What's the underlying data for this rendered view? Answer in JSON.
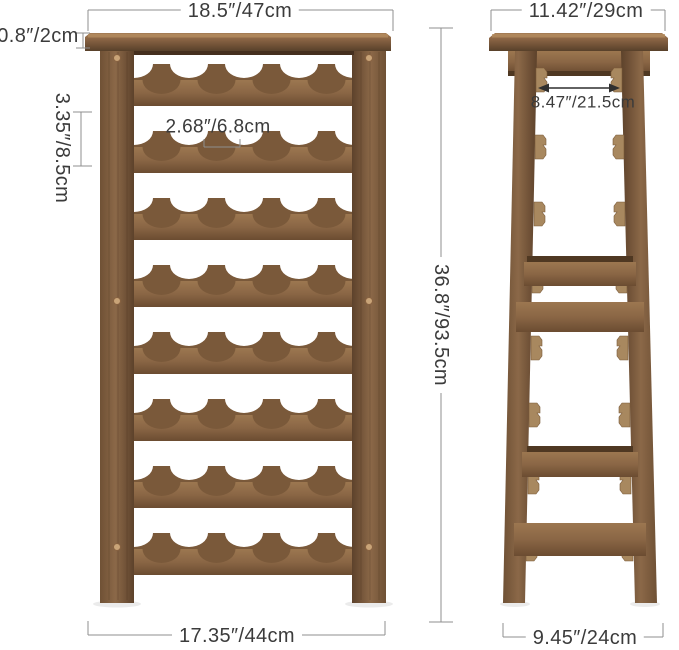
{
  "front_view": {
    "labels": {
      "top_width": "18.5″/47cm",
      "top_thickness": "0.8″/2cm",
      "row_spacing": "3.35″/8.5cm",
      "slot_width": "2.68″/6.8cm",
      "total_height": "36.8″/93.5cm",
      "bottom_width": "17.35″/44cm"
    }
  },
  "side_view": {
    "labels": {
      "top_depth": "11.42″/29cm",
      "inner_depth": "8.47″/21.5cm",
      "bottom_depth": "9.45″/24cm"
    }
  },
  "colors": {
    "background": "#ffffff",
    "wood_light": "#9d7851",
    "wood_mid": "#8a6646",
    "wood_dark": "#5f452e",
    "wood_back": "#7a593a",
    "tenon": "#a8885f",
    "dowel": "#c9a478",
    "dim_line": "#8f8f8f",
    "arrow": "#2f2f2f",
    "text": "#3b3b3b"
  }
}
